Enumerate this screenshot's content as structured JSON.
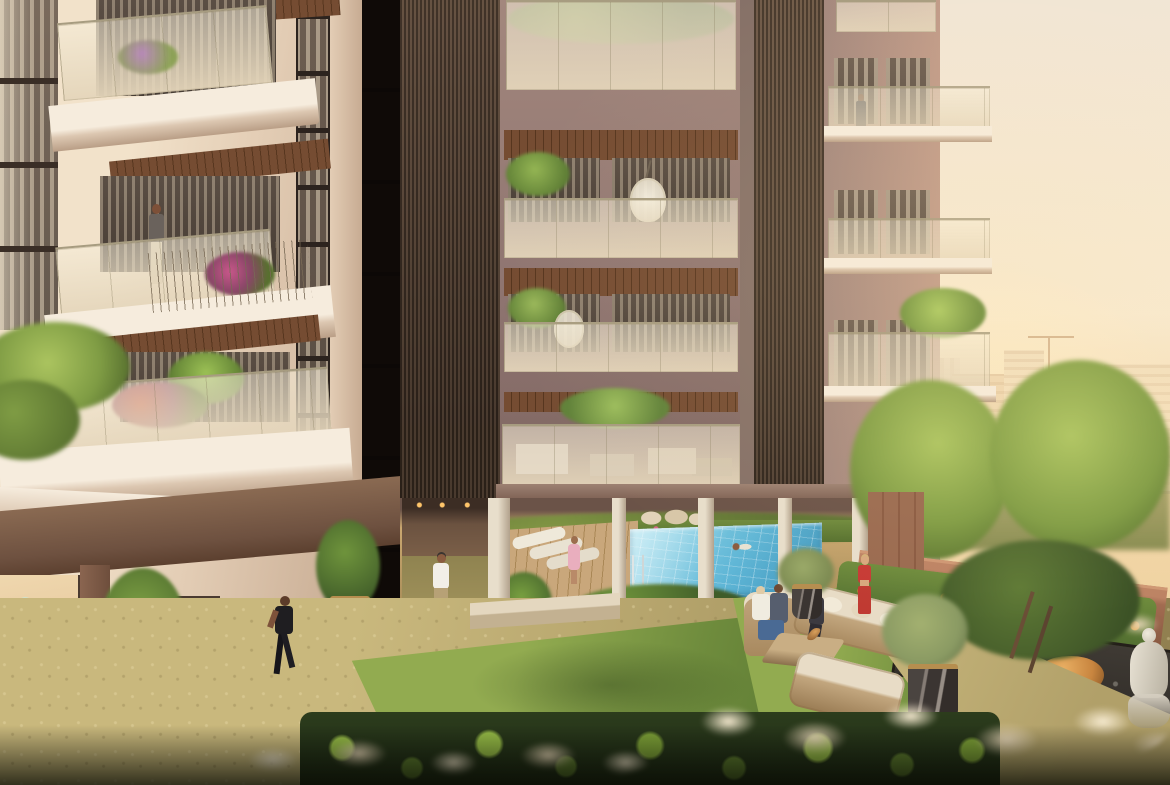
{
  "meta": {
    "description": "Sunset architectural rendering of a residential tower courtyard with swimming pool, landscaped garden, lawn seating area and residents",
    "time_of_day": "golden hour",
    "no_visible_text": true
  },
  "palette": {
    "sky-top": "#f1e6d6",
    "sky-mid": "#f8ead0",
    "sky-low": "#f4d8ab",
    "sun-glow": "#ffeec6",
    "skyline": "#e9cfa9",
    "skyline-far": "#f1ddbc",
    "tower-wall": "#8e7470",
    "tower-wall-light": "#a3877d",
    "tower-pier": "#857067",
    "tower-dark-pier": "#362c26",
    "louver-dark": "#332921",
    "louver-mid": "#6d5949",
    "soffit": "#754c32",
    "soffit-dark": "#57361f",
    "glass-top": "rgba(246,238,218,0.55)",
    "glass-bot": "rgba(228,213,186,0.95)",
    "glass-frame": "#a79c80",
    "leftb-wall": "#e3cdb5",
    "leftb-lit": "#f2e2ca",
    "leftb-shadow": "#c7ab92",
    "slab-white": "#f6ecdd",
    "slab-shadow": "#dcc7b1",
    "leftb-brown": "#7b5a43",
    "leftb-terra": "#ad7c61",
    "interior-glow": "#eed3a5",
    "pool-light": "#9adcec",
    "pool-mid": "#5fb6d6",
    "pool-deep": "#3d93ba",
    "deck": "#c9a77b",
    "deck-dark": "#a98756",
    "column-light": "#e8decb",
    "column-dark": "#b2a18c",
    "lawn-lit": "#92ab50",
    "lawn": "#6f8c3d",
    "lawn-dark": "#52702e",
    "gravel-lit": "#c9b87d",
    "gravel": "#b1a069",
    "gravel-dark": "#8f7e4e",
    "hedge-dark": "#202d18",
    "leaf": "#5d7c2f",
    "leaf-lit": "#97bd47",
    "pampas": "#e9d8b9",
    "pampas-lit": "#f7ebd1",
    "terra-wall": "#a26c51",
    "terra-lit": "#bd8364",
    "tree-green": "#7f9c44",
    "tree-lit": "#abc45f",
    "tree-dark": "#5a7330",
    "olive": "#8a9a63",
    "gold": "#b68e4f",
    "wicker": "#c2a67e",
    "cushion": "#e8dcc6",
    "stone-white": "#dbd4c6",
    "stone-orange": "#c8853f",
    "trough": "#34302b",
    "skin": "#caa183",
    "robe-pink": "#e9aebe",
    "red-outfit": "#c73a35",
    "denim": "#4a6a94",
    "shirt-white": "#f2efe8",
    "shorts-khaki": "#b7a176",
    "black-outfit": "#1f1e21",
    "tank-grey": "#6a625c",
    "pants-beige": "#cfc0a4"
  },
  "scene": {
    "buildings": [
      {
        "name": "left-residential-wing",
        "style": "cream facade, projecting balconies with glass and picket rails, wood soffits, ground-floor retail glazing"
      },
      {
        "name": "central-tower",
        "style": "mauve-taupe frame, dark vertical louver wings, recessed balconies with frosted glass, hung egg chair, stilt ground level"
      },
      {
        "name": "distant-city-skyline",
        "style": "hazy warm mid-rise blocks with construction crane"
      }
    ],
    "amenities": [
      {
        "name": "swimming-pool",
        "detail": "blue tiled pool under stilted tower, chrome ladder, one swimmer"
      },
      {
        "name": "pool-deck",
        "detail": "timber deck with three white sun loungers"
      },
      {
        "name": "clubhouse-glass-lounge",
        "detail": "first floor amenity behind continuous glass balustrade"
      },
      {
        "name": "garden-seating",
        "detail": "wicker sofa set with cream cushions and coffee table on lawn"
      },
      {
        "name": "zen-rock-garden",
        "detail": "pebble trough, white and ochre boulders, pampas grass, buddha statue"
      },
      {
        "name": "retail-bakery-display",
        "detail": "ground floor window with pastries and pastel balloons"
      }
    ],
    "people": [
      {
        "name": "balcony-man",
        "where": "left wing balcony, standing"
      },
      {
        "name": "tower-balcony-man",
        "where": "right bay balcony of tower"
      },
      {
        "name": "jogger-black",
        "where": "gravel walk, black activewear"
      },
      {
        "name": "jogger-white",
        "where": "path under tower, white tee and khaki shorts"
      },
      {
        "name": "woman-pink-robe",
        "where": "pool deck"
      },
      {
        "name": "swimmer",
        "where": "in pool"
      },
      {
        "name": "couple-on-armchair",
        "where": "garden seating"
      },
      {
        "name": "woman-on-sofa",
        "where": "garden seating"
      },
      {
        "name": "woman-red-outfit",
        "where": "walking garden path"
      }
    ],
    "vegetation": [
      "courtyard lawn",
      "bamboo planters in marble pots",
      "olive trees in gold-band pots",
      "balcony palms and bougainvillea",
      "foreground tropical hedge",
      "white pampas grass",
      "garden trees"
    ]
  }
}
